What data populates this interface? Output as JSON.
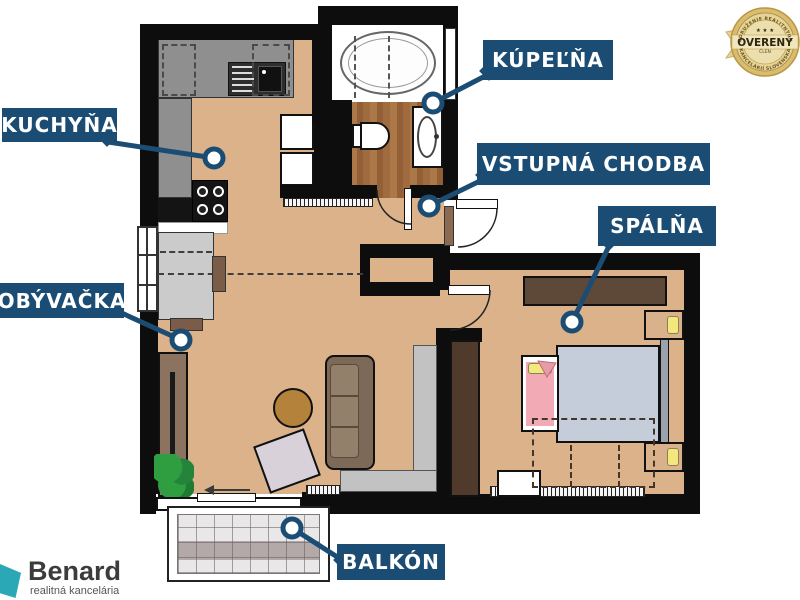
{
  "floorplan": {
    "rooms": [
      {
        "id": "kuchyna",
        "label": "KUCHYŇA"
      },
      {
        "id": "kupelna",
        "label": "KÚPEĽŇA"
      },
      {
        "id": "vstupna_chodba",
        "label": "VSTUPNÁ CHODBA"
      },
      {
        "id": "spalna",
        "label": "SPÁLŇA"
      },
      {
        "id": "obyvacka",
        "label": "OBÝVAČKA"
      },
      {
        "id": "balkon",
        "label": "BALKÓN"
      }
    ]
  },
  "badge": {
    "title": "OVERENÝ",
    "subtitle": "ČLEN",
    "stars": "★ ★ ★",
    "arc_top": "ZDRUŽENIE REALITNÝCH",
    "arc_bottom": "KANCELÁRIÍ SLOVENSKA"
  },
  "logo": {
    "name": "Benard",
    "tagline": "realitná kancelária"
  },
  "colors": {
    "accent_navy": "#1b4d74",
    "wall": "#0d0d0d",
    "floor_tan": "#dcb28a",
    "counter_gray": "#8f8f8f",
    "wood_brown": "#a9734a",
    "bed_blue": "#c5cdda",
    "sofa_brown": "#7c6957",
    "badge_gold": "#d9bc6d",
    "logo_teal": "#2ba8b5"
  }
}
